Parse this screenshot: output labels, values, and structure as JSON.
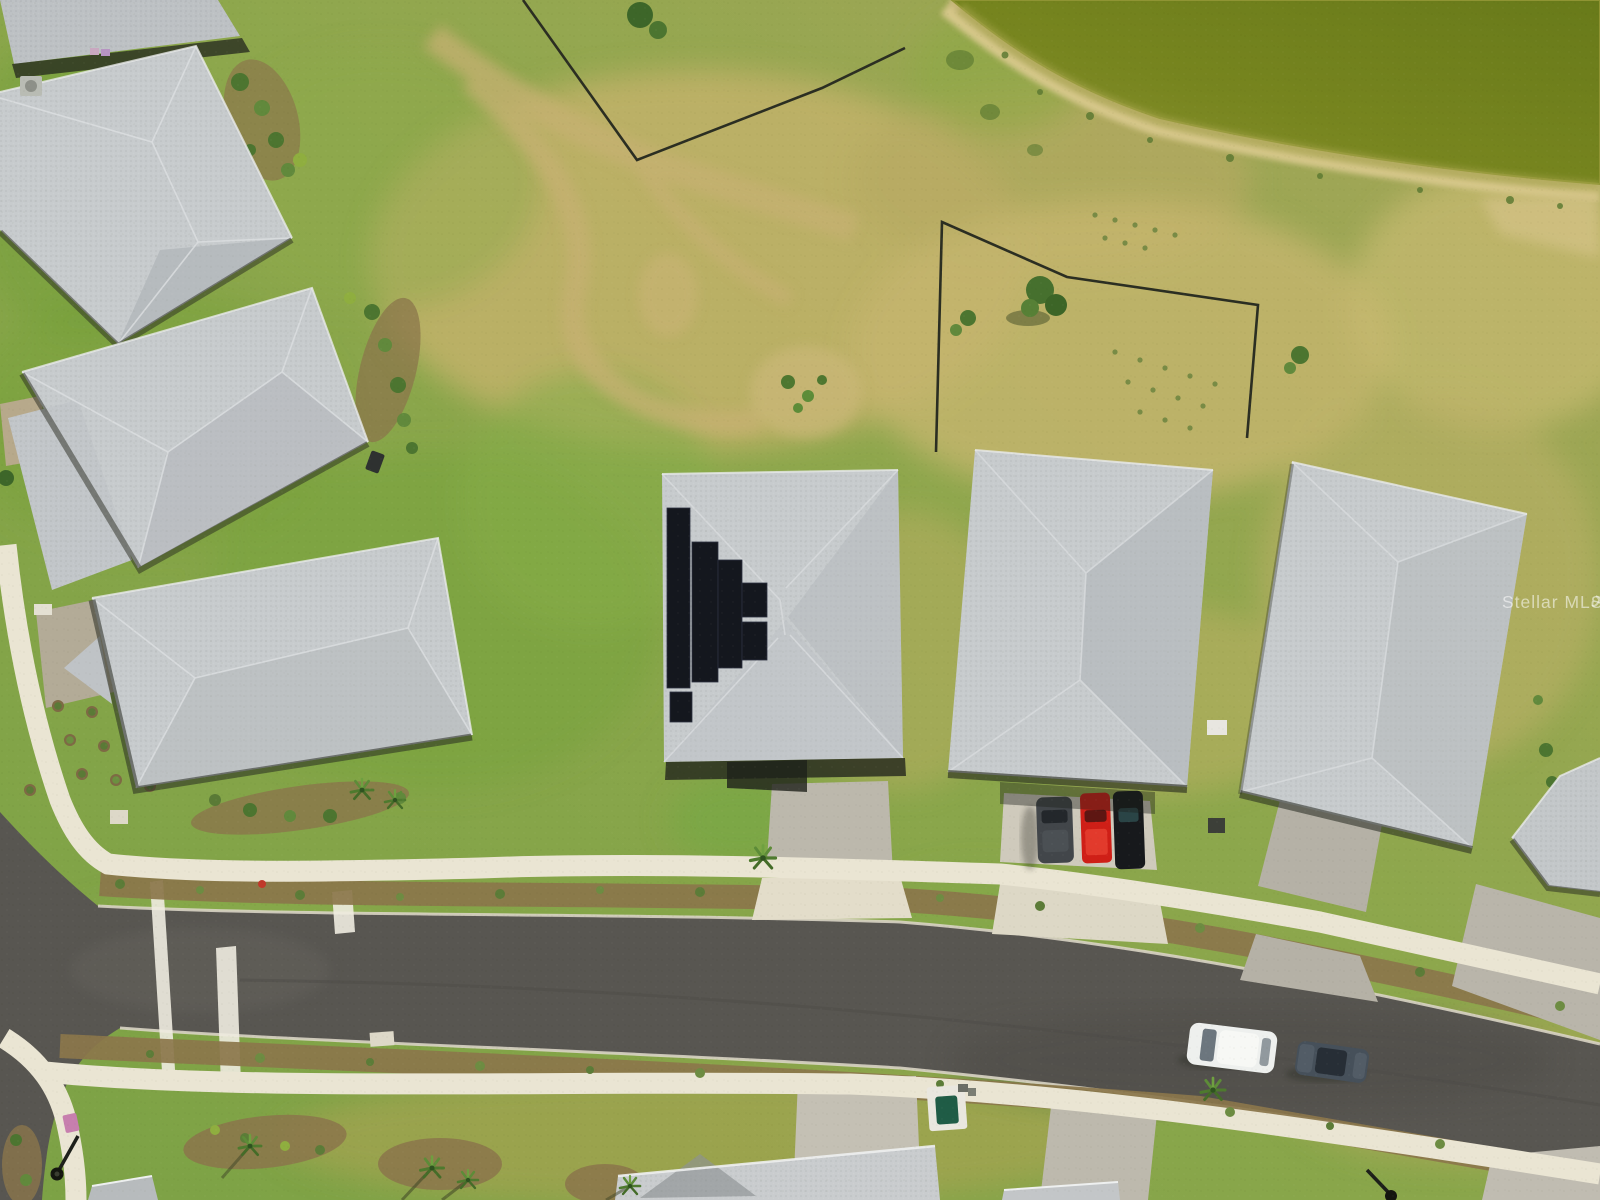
{
  "meta": {
    "type": "aerial-drone-photo",
    "subject": "Overhead view of a new residential neighborhood with gray hip-roof homes, one roof with solar panels, a curving street with sidewalks, dry grass field, black fencing and a retention pond"
  },
  "watermark": {
    "text": "Stellar MLS"
  },
  "colors": {
    "grass_base": "#86a34a",
    "grass_dry": "#c2b26a",
    "pond_deep": "#687a1a",
    "pond_shallow": "#8f9433",
    "sand": "#d9c98e",
    "asphalt": "#585651",
    "concrete": "#eae5d3",
    "paver": "#bcb8ac",
    "paver_light": "#cfcabc",
    "mulch": "#8b764b",
    "roof_light": "#c7cbcd",
    "roof_shade": "#b2b6ba",
    "eave_shadow": "#24271e",
    "solar_panel": "#14171e",
    "fence": "#2b2e22",
    "car_red": "#cf1f17",
    "car_white": "#eef0ee",
    "car_black": "#17191c",
    "car_gray": "#42464a",
    "car_slate": "#46505a",
    "pool_green": "#1f5c46",
    "mailbox_pink": "#c77fae",
    "shrub_green": "#5c7c38"
  },
  "scene": {
    "houses_full": 5,
    "houses_partial": 5,
    "solar_panel_house": true,
    "driveway_cars": [
      "gray-suv",
      "red-truck",
      "black-suv"
    ],
    "street_cars": [
      "white-suv",
      "slate-sedan"
    ],
    "road": "residential street with painted stop bar and edge line",
    "pond": "retention pond with sandy shoreline, upper right",
    "fenced_lots": 2
  }
}
